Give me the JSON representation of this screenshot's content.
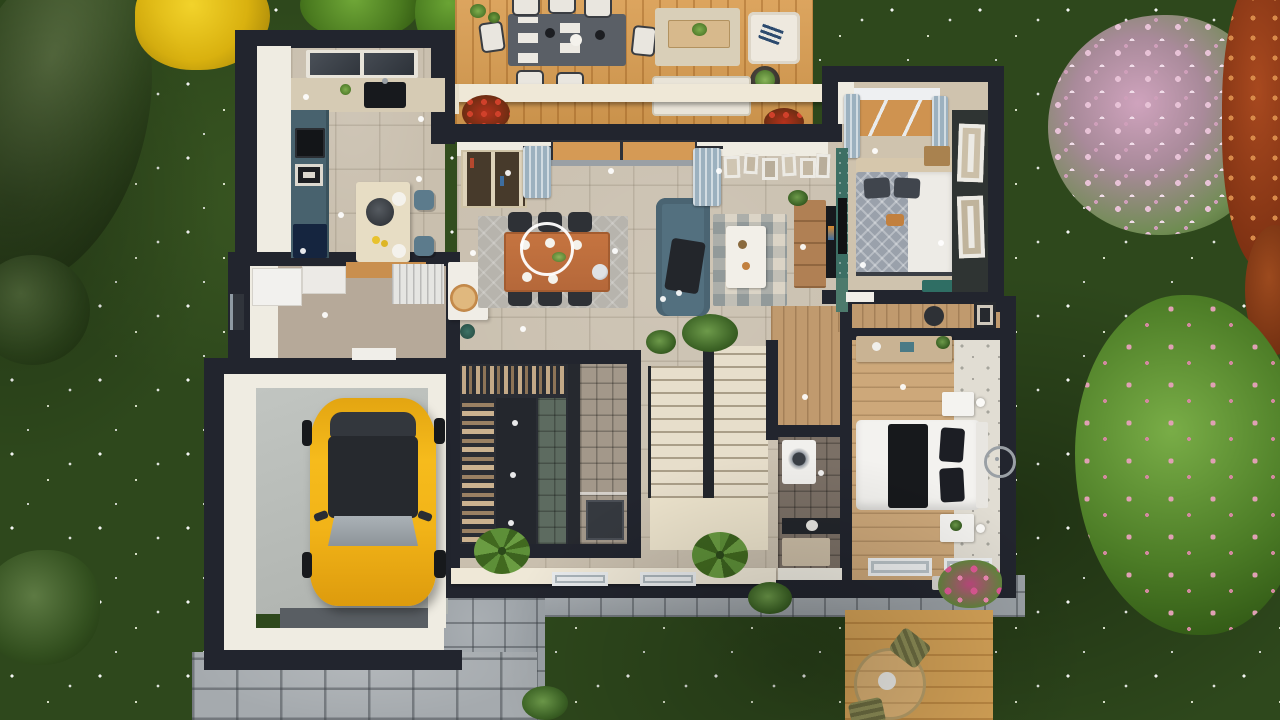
{
  "scene": {
    "type": "3d-floor-plan-render-top-view",
    "palette": {
      "grass": "#2e481c",
      "exterior_wall": "#22252e",
      "wall_top_band": "#efece2",
      "tile_floor": "#c9bfae",
      "deck_wood": "#d99d51",
      "stone_path": "#9ba1a6",
      "car_yellow": "#f2b418",
      "sofa_blue": "#53707f",
      "counter_slate": "#48626e",
      "curtain_blue": "#9cb1bf",
      "accent_teal": "#3c6f64",
      "stairs_beige": "#e7decb"
    },
    "rooms": [
      {
        "name": "kitchen"
      },
      {
        "name": "living-room"
      },
      {
        "name": "dining-area"
      },
      {
        "name": "entry-hall"
      },
      {
        "name": "pantry-laundry"
      },
      {
        "name": "garage"
      },
      {
        "name": "walk-in-closet"
      },
      {
        "name": "shower-room"
      },
      {
        "name": "staircase"
      },
      {
        "name": "bathroom"
      },
      {
        "name": "hallway-office"
      },
      {
        "name": "bedroom-1"
      },
      {
        "name": "bedroom-2"
      },
      {
        "name": "north-terrace-deck"
      },
      {
        "name": "south-patio-deck"
      },
      {
        "name": "driveway"
      },
      {
        "name": "garden"
      }
    ],
    "objects": [
      {
        "name": "yellow-car",
        "location": "garage"
      },
      {
        "name": "kitchen-island-with-stools",
        "location": "kitchen"
      },
      {
        "name": "skylight",
        "location": "kitchen"
      },
      {
        "name": "dining-table-six-chairs",
        "location": "dining-area"
      },
      {
        "name": "ring-chandelier",
        "location": "dining-area"
      },
      {
        "name": "blue-sofa",
        "location": "living-room"
      },
      {
        "name": "patterned-rug",
        "location": "living-room"
      },
      {
        "name": "tv-console",
        "location": "living-room"
      },
      {
        "name": "gallery-wall-frames",
        "location": "living-room"
      },
      {
        "name": "bookshelf",
        "location": "living-room"
      },
      {
        "name": "u-shaped-staircase",
        "location": "staircase"
      },
      {
        "name": "washing-machine",
        "location": "bathroom"
      },
      {
        "name": "wardrobe-with-clothes",
        "location": "walk-in-closet"
      },
      {
        "name": "double-bed-gray",
        "location": "bedroom-1"
      },
      {
        "name": "double-bed-black-white",
        "location": "bedroom-2"
      },
      {
        "name": "wall-clock",
        "location": "bedroom-2"
      },
      {
        "name": "outdoor-dining-set",
        "location": "north-terrace-deck"
      },
      {
        "name": "outdoor-lounge-sofa",
        "location": "north-terrace-deck"
      },
      {
        "name": "round-patio-table",
        "location": "south-patio-deck"
      },
      {
        "name": "yellow-tree",
        "location": "garden"
      },
      {
        "name": "pink-flowering-tree",
        "location": "garden"
      },
      {
        "name": "conifer-trees",
        "location": "garden"
      }
    ]
  }
}
